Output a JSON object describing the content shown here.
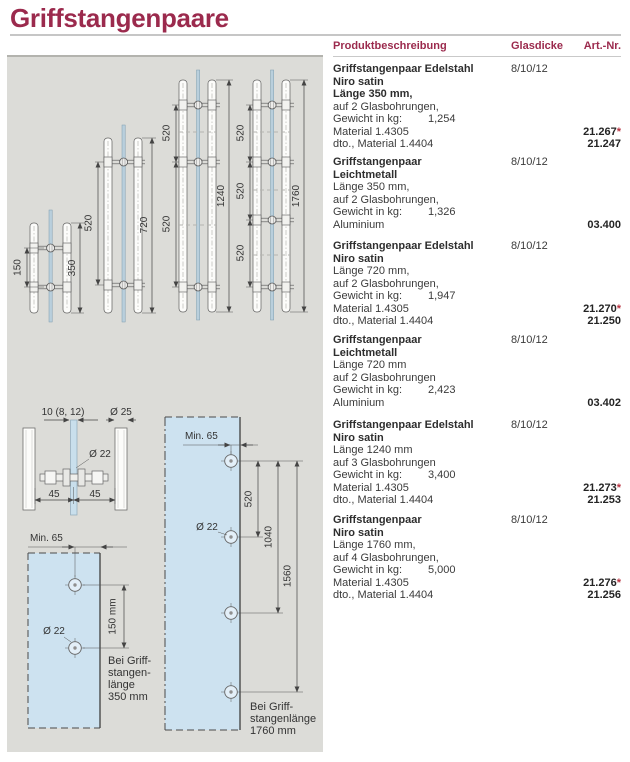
{
  "page": {
    "title": "Griffstangenpaare",
    "accent_color": "#9b2a4d",
    "star_color": "#b93442",
    "panel_bg": "#dcdcd8",
    "glass_blue": "#cde2f0"
  },
  "table": {
    "headers": {
      "product": "Produktbeschreibung",
      "glass": "Glasdicke",
      "art": "Art.-Nr."
    },
    "rows": [
      {
        "bold": [
          "Griffstangenpaar Edelstahl",
          "Niro satin",
          "Länge 350 mm,"
        ],
        "reg": [
          "auf 2 Glasbohrungen,"
        ],
        "weight_label": "Gewicht in kg:",
        "weight": "1,254",
        "mat": [
          "Material 1.4305",
          "dto., Material 1.4404"
        ],
        "glasdicke": "8/10/12",
        "art": [
          {
            "nr": "21.267",
            "star": "*"
          },
          {
            "nr": "21.247",
            "star": ""
          }
        ]
      },
      {
        "bold": [
          "Griffstangenpaar",
          "Leichtmetall"
        ],
        "reg": [
          "Länge 350 mm,",
          "auf 2 Glasbohrungen,"
        ],
        "weight_label": "Gewicht in kg:",
        "weight": "1,326",
        "mat": [
          "Aluminium"
        ],
        "glasdicke": "8/10/12",
        "art": [
          {
            "nr": "03.400",
            "star": ""
          }
        ]
      },
      {
        "bold": [
          "Griffstangenpaar Edelstahl",
          "Niro satin"
        ],
        "reg": [
          "Länge 720 mm,",
          "auf 2 Glasbohrungen,"
        ],
        "weight_label": "Gewicht in kg:",
        "weight": "1,947",
        "mat": [
          "Material 1.4305",
          "dto., Material 1.4404"
        ],
        "glasdicke": "8/10/12",
        "art": [
          {
            "nr": "21.270",
            "star": "*"
          },
          {
            "nr": "21.250",
            "star": ""
          }
        ]
      },
      {
        "bold": [
          "Griffstangenpaar",
          "Leichtmetall"
        ],
        "reg": [
          "Länge 720 mm",
          "auf 2 Glasbohrungen"
        ],
        "weight_label": "Gewicht in kg:",
        "weight": "2,423",
        "mat": [
          "Aluminium"
        ],
        "glasdicke": "8/10/12",
        "art": [
          {
            "nr": "03.402",
            "star": ""
          }
        ]
      },
      {
        "bold": [
          "Griffstangenpaar Edelstahl",
          "Niro satin"
        ],
        "reg": [
          "Länge 1240 mm",
          "auf 3 Glasbohrungen"
        ],
        "weight_label": "Gewicht in kg:",
        "weight": "3,400",
        "mat": [
          "Material 1.4305",
          "dto., Material 1.4404"
        ],
        "glasdicke": "8/10/12",
        "art": [
          {
            "nr": "21.273",
            "star": "*"
          },
          {
            "nr": "21.253",
            "star": ""
          }
        ]
      },
      {
        "bold": [
          "Griffstangenpaar",
          "Niro satin"
        ],
        "reg": [
          "Länge 1760 mm,",
          "auf 4 Glasbohrungen,"
        ],
        "weight_label": "Gewicht in kg:",
        "weight": "5,000",
        "mat": [
          "Material 1.4305",
          "dto., Material 1.4404"
        ],
        "glasdicke": "8/10/12",
        "art": [
          {
            "nr": "21.276",
            "star": "*"
          },
          {
            "nr": "21.256",
            "star": ""
          }
        ]
      }
    ]
  },
  "drawings": {
    "handle_350": {
      "dim_inner": "150",
      "dim_outer": "350"
    },
    "handle_720": {
      "dim_inner": "520",
      "dim_outer": "720"
    },
    "handle_1240": {
      "dim_inner": "520",
      "dim_outer": "1240"
    },
    "handle_1760": {
      "dim_inner": "520",
      "dim_outer": "1760"
    },
    "cross_section": {
      "glass_thickness_label": "10 (8, 12)",
      "bar_diameter_label": "Ø 25",
      "hole_diameter_label": "Ø 22",
      "offset_left": "45",
      "offset_right": "45"
    },
    "glass_350": {
      "min_edge": "Min. 65",
      "hole_spacing": "150 mm",
      "hole_diameter_label": "Ø 22",
      "caption": [
        "Bei Griff-",
        "stangen-",
        "länge",
        "350 mm"
      ]
    },
    "glass_1760": {
      "min_edge": "Min. 65",
      "hole_diameter_label": "Ø 22",
      "dims": [
        "520",
        "1040",
        "1560"
      ],
      "caption": [
        "Bei Griff-",
        "stangenlänge",
        "1760 mm"
      ]
    }
  }
}
